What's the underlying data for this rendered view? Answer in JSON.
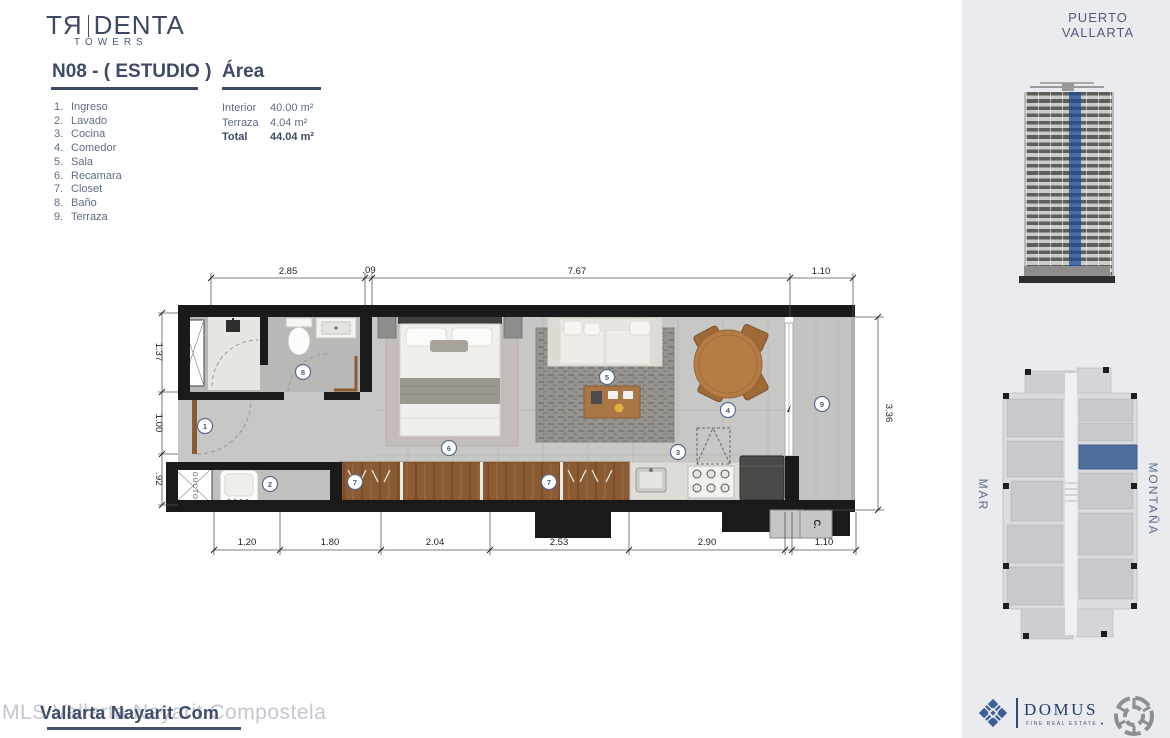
{
  "brand": {
    "logo_main": "TЯ|DENTA",
    "logo_pre": "TЯ",
    "logo_post": "DENTA",
    "logo_sub": "TOWERS"
  },
  "header": {
    "unit_title": "N08 - ( ESTUDIO )",
    "area_title": "Área"
  },
  "rooms": [
    {
      "n": "1.",
      "label": "Ingreso"
    },
    {
      "n": "2.",
      "label": "Lavado"
    },
    {
      "n": "3.",
      "label": "Cocina"
    },
    {
      "n": "4.",
      "label": "Comedor"
    },
    {
      "n": "5.",
      "label": "Sala"
    },
    {
      "n": "6.",
      "label": "Recamara"
    },
    {
      "n": "7.",
      "label": "Closet"
    },
    {
      "n": "8.",
      "label": "Baño"
    },
    {
      "n": "9.",
      "label": "Terraza"
    }
  ],
  "areas": [
    {
      "label": "Interior",
      "value": "40.00 m²"
    },
    {
      "label": "Terraza",
      "value": "4.04 m²"
    },
    {
      "label": "Total",
      "value": "44.04 m²"
    }
  ],
  "plan": {
    "dims_top": [
      "2.85",
      ".09",
      "7.67",
      "1.10"
    ],
    "dims_bottom": [
      "1.20",
      "1.80",
      "2.04",
      "2.53",
      "2.90",
      "1.10"
    ],
    "dims_left": [
      "1.37",
      "1.00",
      ".92"
    ],
    "dims_right": [
      "3.36"
    ],
    "room_numbers": [
      "1",
      "2",
      "3",
      "4",
      "5",
      "6",
      "7",
      "7",
      "8",
      "9"
    ],
    "duct_label": "DUCTO",
    "closet_label": "C."
  },
  "side_panel": {
    "location": "PUERTO VALLARTA",
    "mar_label": "MAR",
    "montana_label": "MONTAÑA",
    "highlight_color": "#4e6e9e"
  },
  "watermark": {
    "light": "MLS Vallarta Nayarit Compostela",
    "dark": "Vallarta Nayarit Com"
  },
  "footer": {
    "domus_name": "DOMUS",
    "domus_tagline": "FINE REAL ESTATE ●"
  },
  "colors": {
    "accent_blue": "#3e4a66",
    "panel_bg": "#e9ebee",
    "wall": "#1a1a1a",
    "wood": "#8a5a33",
    "unit_highlight": "#4e6e9e"
  }
}
